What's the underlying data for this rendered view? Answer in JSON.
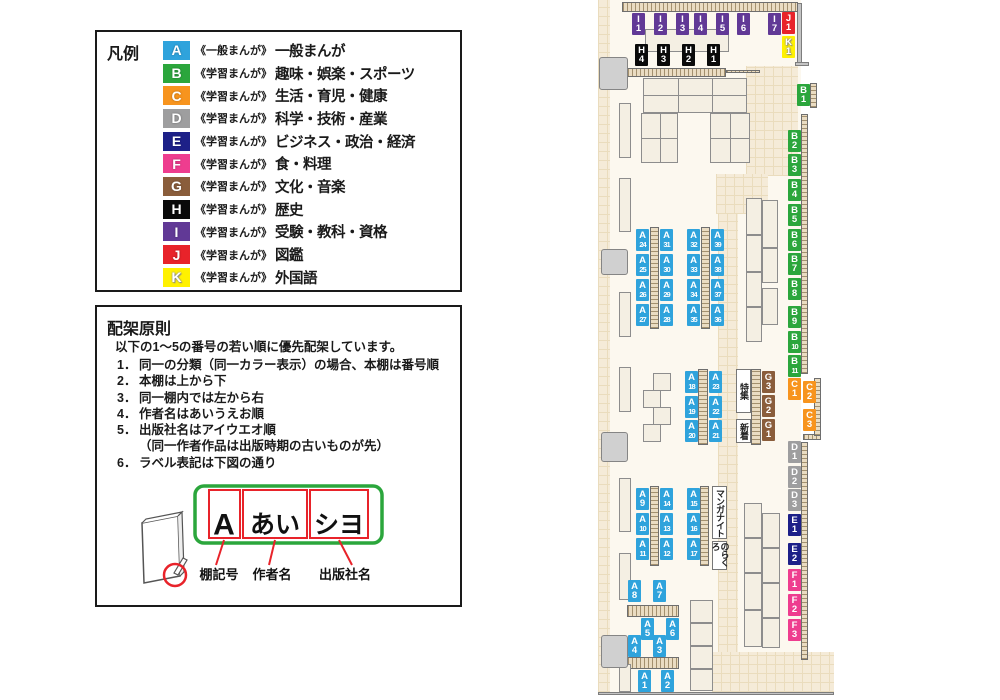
{
  "colors": {
    "A": "#2FA3DC",
    "B": "#2BA63C",
    "C": "#F7941E",
    "D": "#9E9E9F",
    "E": "#1D2088",
    "F": "#EE3D8F",
    "G": "#8A5D3B",
    "H": "#0A0A0A",
    "I": "#613996",
    "J": "#E8232A",
    "K": "#FFF100",
    "diagram_green": "#2BA63C",
    "diagram_red": "#E8232A"
  },
  "legend": {
    "title": "凡例",
    "items": [
      {
        "letter": "A",
        "tag": "《一般まんが》",
        "label": "一般まんが"
      },
      {
        "letter": "B",
        "tag": "《学習まんが》",
        "label": "趣味・娯楽・スポーツ"
      },
      {
        "letter": "C",
        "tag": "《学習まんが》",
        "label": "生活・育児・健康"
      },
      {
        "letter": "D",
        "tag": "《学習まんが》",
        "label": "科学・技術・産業"
      },
      {
        "letter": "E",
        "tag": "《学習まんが》",
        "label": "ビジネス・政治・経済"
      },
      {
        "letter": "F",
        "tag": "《学習まんが》",
        "label": "食・料理"
      },
      {
        "letter": "G",
        "tag": "《学習まんが》",
        "label": "文化・音楽"
      },
      {
        "letter": "H",
        "tag": "《学習まんが》",
        "label": "歴史"
      },
      {
        "letter": "I",
        "tag": "《学習まんが》",
        "label": "受験・教科・資格"
      },
      {
        "letter": "J",
        "tag": "《学習まんが》",
        "label": "図鑑"
      },
      {
        "letter": "K",
        "tag": "《学習まんが》",
        "label": "外国語"
      }
    ]
  },
  "principles": {
    "title": "配架原則",
    "intro": "以下の1～5の番号の若い順に優先配架しています。",
    "items": [
      {
        "num": "1．",
        "text": "同一の分類（同一カラー表示）の場合、本棚は番号順"
      },
      {
        "num": "2．",
        "text": "本棚は上から下"
      },
      {
        "num": "3．",
        "text": "同一棚内では左から右"
      },
      {
        "num": "4．",
        "text": "作者名はあいうえお順"
      },
      {
        "num": "5．",
        "text": "出版社名はアイウエオ順"
      },
      {
        "num": "",
        "text": "（同一作者作品は出版時期の古いものが先）"
      },
      {
        "num": "6．",
        "text": "ラベル表記は下図の通り"
      }
    ],
    "diagram": {
      "shelf_code": "A",
      "author": "あい",
      "publisher": "シヨ",
      "labels": [
        "棚記号",
        "作者名",
        "出版社名"
      ]
    }
  },
  "map": {
    "text_boxes": [
      {
        "text": "特集",
        "x": 736,
        "y": 369,
        "w": 15,
        "h": 44
      },
      {
        "text": "新着",
        "x": 736,
        "y": 419,
        "w": 15,
        "h": 24
      },
      {
        "text": "マンガナイト",
        "x": 712,
        "y": 486,
        "w": 15,
        "h": 53
      },
      {
        "text": "のらくろ",
        "x": 712,
        "y": 541,
        "w": 15,
        "h": 29
      }
    ],
    "fixtures": [
      {
        "t": "floor",
        "x": 609,
        "y": 0,
        "w": 192,
        "h": 692
      },
      {
        "t": "tile",
        "x": 598,
        "y": 0,
        "w": 12,
        "h": 692
      },
      {
        "t": "tile",
        "x": 746,
        "y": 66,
        "w": 52,
        "h": 110
      },
      {
        "t": "tile",
        "x": 716,
        "y": 174,
        "w": 52,
        "h": 40
      },
      {
        "t": "tile",
        "x": 718,
        "y": 214,
        "w": 20,
        "h": 440
      },
      {
        "t": "tile",
        "x": 712,
        "y": 652,
        "w": 122,
        "h": 40
      },
      {
        "t": "wall",
        "x": 797,
        "y": 3,
        "w": 5,
        "h": 62
      },
      {
        "t": "wall",
        "x": 795,
        "y": 62,
        "w": 14,
        "h": 4
      },
      {
        "t": "wall",
        "x": 598,
        "y": 692,
        "w": 236,
        "h": 3
      },
      {
        "t": "strip-h",
        "x": 622,
        "y": 2,
        "w": 176,
        "h": 10
      },
      {
        "t": "strip-h",
        "x": 627,
        "y": 68,
        "w": 99,
        "h": 9
      },
      {
        "t": "strip-h",
        "x": 726,
        "y": 70,
        "w": 34,
        "h": 3
      },
      {
        "t": "strip-h",
        "x": 803,
        "y": 434,
        "w": 18,
        "h": 6
      },
      {
        "t": "strip-h",
        "x": 627,
        "y": 605,
        "w": 52,
        "h": 12
      },
      {
        "t": "strip-h",
        "x": 627,
        "y": 657,
        "w": 52,
        "h": 12
      },
      {
        "t": "strip-v",
        "x": 801,
        "y": 114,
        "w": 7,
        "h": 260
      },
      {
        "t": "strip-v",
        "x": 814,
        "y": 378,
        "w": 7,
        "h": 58
      },
      {
        "t": "strip-v",
        "x": 801,
        "y": 442,
        "w": 7,
        "h": 218
      },
      {
        "t": "strip-v",
        "x": 810,
        "y": 83,
        "w": 7,
        "h": 25
      },
      {
        "t": "strip-v",
        "x": 650,
        "y": 227,
        "w": 9,
        "h": 102
      },
      {
        "t": "strip-v",
        "x": 701,
        "y": 227,
        "w": 9,
        "h": 102
      },
      {
        "t": "strip-v",
        "x": 698,
        "y": 369,
        "w": 10,
        "h": 76
      },
      {
        "t": "strip-v",
        "x": 751,
        "y": 369,
        "w": 10,
        "h": 76
      },
      {
        "t": "strip-v",
        "x": 650,
        "y": 486,
        "w": 9,
        "h": 80
      },
      {
        "t": "strip-v",
        "x": 700,
        "y": 486,
        "w": 9,
        "h": 80
      },
      {
        "t": "block",
        "x": 645,
        "y": 29,
        "w": 84,
        "h": 23
      },
      {
        "t": "block",
        "x": 643,
        "y": 78,
        "w": 104,
        "h": 35
      },
      {
        "t": "block",
        "x": 641,
        "y": 113,
        "w": 37,
        "h": 50
      },
      {
        "t": "block",
        "x": 710,
        "y": 113,
        "w": 40,
        "h": 50
      },
      {
        "t": "divider",
        "x": 678,
        "y": 78,
        "w": 1,
        "h": 35
      },
      {
        "t": "divider",
        "x": 712,
        "y": 78,
        "w": 1,
        "h": 35
      },
      {
        "t": "divider",
        "x": 643,
        "y": 95,
        "w": 104,
        "h": 1
      },
      {
        "t": "divider",
        "x": 660,
        "y": 113,
        "w": 1,
        "h": 50
      },
      {
        "t": "divider",
        "x": 641,
        "y": 138,
        "w": 37,
        "h": 1
      },
      {
        "t": "divider",
        "x": 730,
        "y": 113,
        "w": 1,
        "h": 50
      },
      {
        "t": "divider",
        "x": 710,
        "y": 138,
        "w": 40,
        "h": 1
      },
      {
        "t": "block",
        "x": 619,
        "y": 103,
        "w": 12,
        "h": 55
      },
      {
        "t": "block",
        "x": 619,
        "y": 178,
        "w": 12,
        "h": 54
      },
      {
        "t": "block",
        "x": 619,
        "y": 292,
        "w": 12,
        "h": 45
      },
      {
        "t": "block",
        "x": 619,
        "y": 367,
        "w": 12,
        "h": 45
      },
      {
        "t": "block",
        "x": 619,
        "y": 478,
        "w": 12,
        "h": 54
      },
      {
        "t": "block",
        "x": 619,
        "y": 553,
        "w": 12,
        "h": 47
      },
      {
        "t": "block",
        "x": 619,
        "y": 664,
        "w": 12,
        "h": 28
      },
      {
        "t": "pillar",
        "x": 599,
        "y": 57,
        "w": 29,
        "h": 33
      },
      {
        "t": "pillar",
        "x": 601,
        "y": 249,
        "w": 27,
        "h": 26
      },
      {
        "t": "pillar",
        "x": 601,
        "y": 432,
        "w": 27,
        "h": 30
      },
      {
        "t": "pillar",
        "x": 601,
        "y": 635,
        "w": 27,
        "h": 33
      },
      {
        "t": "block",
        "x": 746,
        "y": 198,
        "w": 16,
        "h": 37
      },
      {
        "t": "block",
        "x": 746,
        "y": 235,
        "w": 16,
        "h": 37
      },
      {
        "t": "block",
        "x": 746,
        "y": 272,
        "w": 16,
        "h": 35
      },
      {
        "t": "block",
        "x": 746,
        "y": 307,
        "w": 16,
        "h": 35
      },
      {
        "t": "block",
        "x": 762,
        "y": 200,
        "w": 16,
        "h": 48
      },
      {
        "t": "block",
        "x": 762,
        "y": 248,
        "w": 16,
        "h": 35
      },
      {
        "t": "block",
        "x": 762,
        "y": 288,
        "w": 16,
        "h": 37
      },
      {
        "t": "block",
        "x": 653,
        "y": 373,
        "w": 18,
        "h": 18
      },
      {
        "t": "block",
        "x": 643,
        "y": 390,
        "w": 18,
        "h": 18
      },
      {
        "t": "block",
        "x": 653,
        "y": 407,
        "w": 18,
        "h": 18
      },
      {
        "t": "block",
        "x": 643,
        "y": 424,
        "w": 18,
        "h": 18
      },
      {
        "t": "block",
        "x": 744,
        "y": 503,
        "w": 18,
        "h": 35
      },
      {
        "t": "block",
        "x": 744,
        "y": 538,
        "w": 18,
        "h": 35
      },
      {
        "t": "block",
        "x": 744,
        "y": 573,
        "w": 18,
        "h": 37
      },
      {
        "t": "block",
        "x": 744,
        "y": 610,
        "w": 18,
        "h": 37
      },
      {
        "t": "block",
        "x": 762,
        "y": 513,
        "w": 18,
        "h": 35
      },
      {
        "t": "block",
        "x": 762,
        "y": 548,
        "w": 18,
        "h": 35
      },
      {
        "t": "block",
        "x": 762,
        "y": 583,
        "w": 18,
        "h": 35
      },
      {
        "t": "block",
        "x": 762,
        "y": 618,
        "w": 18,
        "h": 30
      },
      {
        "t": "block",
        "x": 690,
        "y": 600,
        "w": 23,
        "h": 23
      },
      {
        "t": "block",
        "x": 690,
        "y": 623,
        "w": 23,
        "h": 23
      },
      {
        "t": "block",
        "x": 690,
        "y": 646,
        "w": 23,
        "h": 23
      },
      {
        "t": "block",
        "x": 690,
        "y": 669,
        "w": 23,
        "h": 22
      }
    ],
    "labels": [
      {
        "id": "I1",
        "c": "I",
        "n": "1",
        "x": 632,
        "y": 13
      },
      {
        "id": "I2",
        "c": "I",
        "n": "2",
        "x": 654,
        "y": 13
      },
      {
        "id": "I3",
        "c": "I",
        "n": "3",
        "x": 676,
        "y": 13
      },
      {
        "id": "I4",
        "c": "I",
        "n": "4",
        "x": 694,
        "y": 13
      },
      {
        "id": "I5",
        "c": "I",
        "n": "5",
        "x": 716,
        "y": 13
      },
      {
        "id": "I6",
        "c": "I",
        "n": "6",
        "x": 737,
        "y": 13
      },
      {
        "id": "I7",
        "c": "I",
        "n": "7",
        "x": 768,
        "y": 13
      },
      {
        "id": "J1",
        "c": "J",
        "n": "1",
        "x": 782,
        "y": 12
      },
      {
        "id": "K1",
        "c": "K",
        "n": "1",
        "x": 782,
        "y": 36
      },
      {
        "id": "H4",
        "c": "H",
        "n": "4",
        "x": 635,
        "y": 44
      },
      {
        "id": "H3",
        "c": "H",
        "n": "3",
        "x": 657,
        "y": 44
      },
      {
        "id": "H2",
        "c": "H",
        "n": "2",
        "x": 682,
        "y": 44
      },
      {
        "id": "H1",
        "c": "H",
        "n": "1",
        "x": 707,
        "y": 44
      },
      {
        "id": "B1",
        "c": "B",
        "n": "1",
        "x": 797,
        "y": 84
      },
      {
        "id": "B2",
        "c": "B",
        "n": "2",
        "x": 788,
        "y": 130
      },
      {
        "id": "B3",
        "c": "B",
        "n": "3",
        "x": 788,
        "y": 154
      },
      {
        "id": "B4",
        "c": "B",
        "n": "4",
        "x": 788,
        "y": 179
      },
      {
        "id": "B5",
        "c": "B",
        "n": "5",
        "x": 788,
        "y": 204
      },
      {
        "id": "B6",
        "c": "B",
        "n": "6",
        "x": 788,
        "y": 229
      },
      {
        "id": "B7",
        "c": "B",
        "n": "7",
        "x": 788,
        "y": 253
      },
      {
        "id": "B8",
        "c": "B",
        "n": "8",
        "x": 788,
        "y": 278
      },
      {
        "id": "B9",
        "c": "B",
        "n": "9",
        "x": 788,
        "y": 306
      },
      {
        "id": "B10",
        "c": "B",
        "n": "10",
        "x": 788,
        "y": 331
      },
      {
        "id": "B11",
        "c": "B",
        "n": "11",
        "x": 788,
        "y": 355
      },
      {
        "id": "C1",
        "c": "C",
        "n": "1",
        "x": 788,
        "y": 378
      },
      {
        "id": "C2",
        "c": "C",
        "n": "2",
        "x": 803,
        "y": 381
      },
      {
        "id": "C3",
        "c": "C",
        "n": "3",
        "x": 803,
        "y": 409
      },
      {
        "id": "D1",
        "c": "D",
        "n": "1",
        "x": 788,
        "y": 441
      },
      {
        "id": "D2",
        "c": "D",
        "n": "2",
        "x": 788,
        "y": 466
      },
      {
        "id": "D3",
        "c": "D",
        "n": "3",
        "x": 788,
        "y": 489
      },
      {
        "id": "E1",
        "c": "E",
        "n": "1",
        "x": 788,
        "y": 514
      },
      {
        "id": "E2",
        "c": "E",
        "n": "2",
        "x": 788,
        "y": 543
      },
      {
        "id": "F1",
        "c": "F",
        "n": "1",
        "x": 788,
        "y": 569
      },
      {
        "id": "F2",
        "c": "F",
        "n": "2",
        "x": 788,
        "y": 594
      },
      {
        "id": "F3",
        "c": "F",
        "n": "3",
        "x": 788,
        "y": 619
      },
      {
        "id": "G3",
        "c": "G",
        "n": "3",
        "x": 762,
        "y": 371
      },
      {
        "id": "G2",
        "c": "G",
        "n": "2",
        "x": 762,
        "y": 395
      },
      {
        "id": "G1",
        "c": "G",
        "n": "1",
        "x": 762,
        "y": 419
      },
      {
        "id": "A24",
        "c": "A",
        "n": "24",
        "x": 636,
        "y": 229
      },
      {
        "id": "A31",
        "c": "A",
        "n": "31",
        "x": 660,
        "y": 229
      },
      {
        "id": "A25",
        "c": "A",
        "n": "25",
        "x": 636,
        "y": 254
      },
      {
        "id": "A30",
        "c": "A",
        "n": "30",
        "x": 660,
        "y": 254
      },
      {
        "id": "A26",
        "c": "A",
        "n": "26",
        "x": 636,
        "y": 279
      },
      {
        "id": "A29",
        "c": "A",
        "n": "29",
        "x": 660,
        "y": 279
      },
      {
        "id": "A27",
        "c": "A",
        "n": "27",
        "x": 636,
        "y": 304
      },
      {
        "id": "A28",
        "c": "A",
        "n": "28",
        "x": 660,
        "y": 304
      },
      {
        "id": "A32",
        "c": "A",
        "n": "32",
        "x": 687,
        "y": 229
      },
      {
        "id": "A39",
        "c": "A",
        "n": "39",
        "x": 711,
        "y": 229
      },
      {
        "id": "A33",
        "c": "A",
        "n": "33",
        "x": 687,
        "y": 254
      },
      {
        "id": "A38",
        "c": "A",
        "n": "38",
        "x": 711,
        "y": 254
      },
      {
        "id": "A34",
        "c": "A",
        "n": "34",
        "x": 687,
        "y": 279
      },
      {
        "id": "A37",
        "c": "A",
        "n": "37",
        "x": 711,
        "y": 279
      },
      {
        "id": "A35",
        "c": "A",
        "n": "35",
        "x": 687,
        "y": 304
      },
      {
        "id": "A36",
        "c": "A",
        "n": "36",
        "x": 711,
        "y": 304
      },
      {
        "id": "A18",
        "c": "A",
        "n": "18",
        "x": 685,
        "y": 371
      },
      {
        "id": "A23",
        "c": "A",
        "n": "23",
        "x": 709,
        "y": 371
      },
      {
        "id": "A19",
        "c": "A",
        "n": "19",
        "x": 685,
        "y": 396
      },
      {
        "id": "A22",
        "c": "A",
        "n": "22",
        "x": 709,
        "y": 396
      },
      {
        "id": "A20",
        "c": "A",
        "n": "20",
        "x": 685,
        "y": 420
      },
      {
        "id": "A21",
        "c": "A",
        "n": "21",
        "x": 709,
        "y": 420
      },
      {
        "id": "A9",
        "c": "A",
        "n": "9",
        "x": 636,
        "y": 488
      },
      {
        "id": "A14",
        "c": "A",
        "n": "14",
        "x": 660,
        "y": 488
      },
      {
        "id": "A10",
        "c": "A",
        "n": "10",
        "x": 636,
        "y": 513
      },
      {
        "id": "A13",
        "c": "A",
        "n": "13",
        "x": 660,
        "y": 513
      },
      {
        "id": "A11",
        "c": "A",
        "n": "11",
        "x": 636,
        "y": 538
      },
      {
        "id": "A12",
        "c": "A",
        "n": "12",
        "x": 660,
        "y": 538
      },
      {
        "id": "A15",
        "c": "A",
        "n": "15",
        "x": 687,
        "y": 488
      },
      {
        "id": "A16",
        "c": "A",
        "n": "16",
        "x": 687,
        "y": 513
      },
      {
        "id": "A17",
        "c": "A",
        "n": "17",
        "x": 687,
        "y": 538
      },
      {
        "id": "A8",
        "c": "A",
        "n": "8",
        "x": 628,
        "y": 580
      },
      {
        "id": "A7",
        "c": "A",
        "n": "7",
        "x": 653,
        "y": 580
      },
      {
        "id": "A5",
        "c": "A",
        "n": "5",
        "x": 641,
        "y": 618
      },
      {
        "id": "A6",
        "c": "A",
        "n": "6",
        "x": 666,
        "y": 618
      },
      {
        "id": "A4",
        "c": "A",
        "n": "4",
        "x": 628,
        "y": 635
      },
      {
        "id": "A3",
        "c": "A",
        "n": "3",
        "x": 653,
        "y": 635
      },
      {
        "id": "A1",
        "c": "A",
        "n": "1",
        "x": 638,
        "y": 670
      },
      {
        "id": "A2",
        "c": "A",
        "n": "2",
        "x": 661,
        "y": 670
      }
    ]
  }
}
